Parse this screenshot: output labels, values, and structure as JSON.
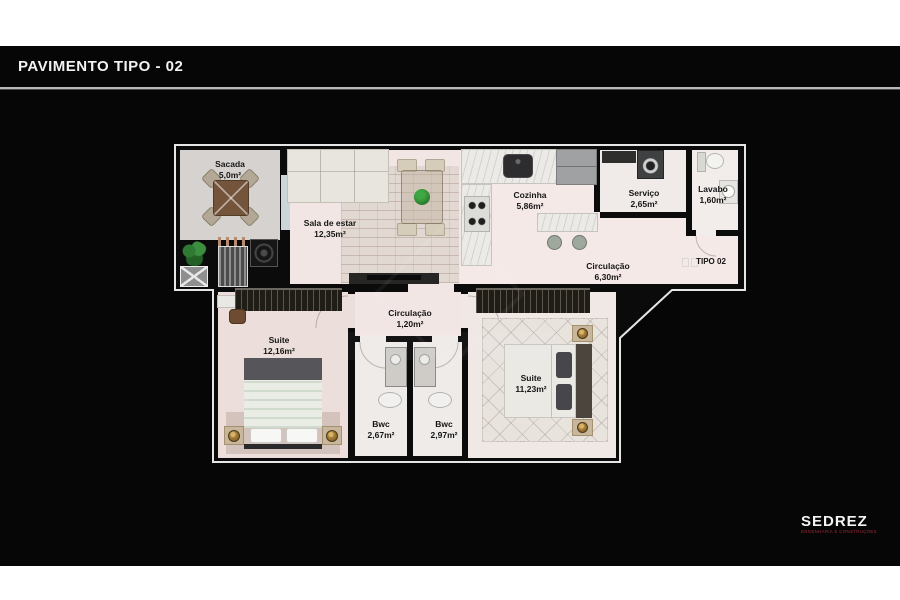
{
  "header": {
    "title": "PAVIMENTO TIPO - 02"
  },
  "plan": {
    "unit_label": "TIPO 02",
    "rooms": [
      {
        "name": "Sacada",
        "area": "5,0m²"
      },
      {
        "name": "Sala de estar",
        "area": "12,35m²"
      },
      {
        "name": "Cozinha",
        "area": "5,86m²"
      },
      {
        "name": "Serviço",
        "area": "2,65m²"
      },
      {
        "name": "Lavabo",
        "area": "1,60m²"
      },
      {
        "name": "Circulação",
        "area": "6,30m²"
      },
      {
        "name": "Circulação",
        "area": "1,20m²"
      },
      {
        "name": "Suite",
        "area": "12,16m²"
      },
      {
        "name": "Suite",
        "area": "11,23m²"
      },
      {
        "name": "Bwc",
        "area": "2,67m²"
      },
      {
        "name": "Bwc",
        "area": "2,97m²"
      }
    ]
  },
  "branding": {
    "logo_text": "SEDREZ",
    "logo_tagline": "ENGENHARIA E CONSTRUÇÕES",
    "logo_color": "#7d1f2a"
  },
  "colors": {
    "background": "#060606",
    "wall": "#0b0b0b",
    "plan_outline": "#e6e6e6",
    "floor": "#f2e6e4",
    "floor_balcony": "#d6d2cf",
    "logo_accent": "#7d1f2a"
  }
}
